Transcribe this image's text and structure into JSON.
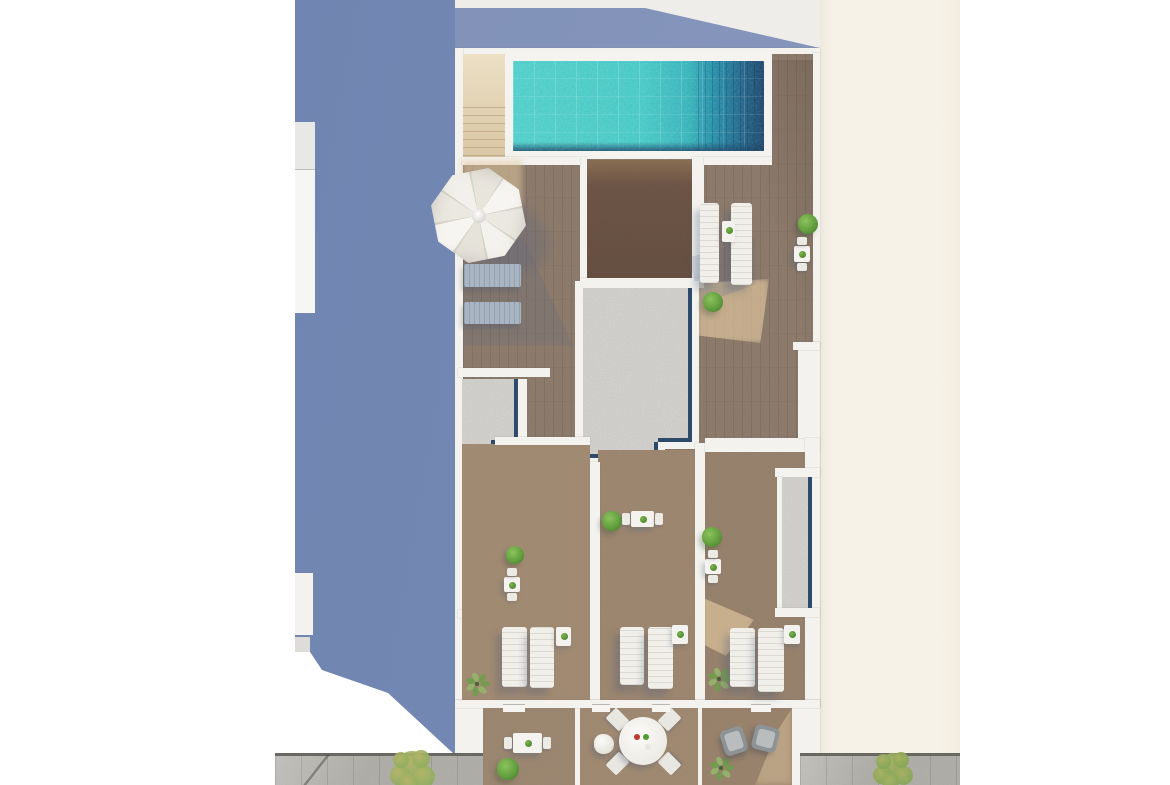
{
  "scene": {
    "type": "architectural-aerial-render",
    "description": "Top-down 3D architectural rendering of a narrow rooftop terrace: turquoise swimming pool with dark deep end at top, sand-colored stair block, white parasol, wooden deck, central gravel roof core, three private wood-floored patios with white sun loungers and small tables, three lower balconies with dining furniture, tall slate-blue side wall on the left and cream neighbouring wall on the right",
    "no_visible_text": true
  },
  "palette": {
    "wall_blue": "#7488b4",
    "awning_blue": "#8494ba",
    "cream_wall": "#f6f2e8",
    "white_wall": "#f3f2ee",
    "deck_wood": "#8d7b6c",
    "room_wood": "#a28b73",
    "dark_room_wood": "#6d5546",
    "terrace_wood": "#9c8771",
    "stairs_sand": "#e3d4b6",
    "sunlight_sand": "#e2c8a0",
    "pool_shallow": "#3fc6c3",
    "pool_deep": "#1b86a3",
    "pool_edge_navy": "#143f66",
    "gravel": "#c8c7c3",
    "planter_edge_navy": "#2e4a6b",
    "paving_gray": "#b2b0aa",
    "bush_green": "#639f3e",
    "plant_green": "#7ca85b",
    "tree_green": "#a3a95f",
    "lounger_white": "#f1efe9",
    "lounger_gray": "#aab5c3",
    "armchair_gray": "#8e9496",
    "umbrella_white": "#f0eee8",
    "accent_red": "#c0392b",
    "accent_green": "#4f9a33"
  },
  "objects": {
    "bushes": [
      {
        "x": 808,
        "y": 224,
        "r": 10
      },
      {
        "x": 713,
        "y": 302,
        "r": 10
      },
      {
        "x": 515,
        "y": 555,
        "r": 9
      },
      {
        "x": 612,
        "y": 521,
        "r": 10
      },
      {
        "x": 712,
        "y": 537,
        "r": 10
      },
      {
        "x": 508,
        "y": 769,
        "r": 11
      }
    ],
    "leafy_plants": [
      {
        "x": 477,
        "y": 684,
        "r": 14
      },
      {
        "x": 719,
        "y": 679,
        "r": 14
      },
      {
        "x": 721,
        "y": 768,
        "r": 14
      }
    ],
    "trees": [
      {
        "x": 412,
        "y": 770,
        "r": 27,
        "c1": "#b5b468",
        "c2": "#8fae5e"
      },
      {
        "x": 893,
        "y": 770,
        "r": 24,
        "c1": "#aab162",
        "c2": "#85a757"
      }
    ],
    "white_loungers": [
      {
        "x": 700,
        "y": 203,
        "w": 19,
        "h": 80
      },
      {
        "x": 731,
        "y": 203,
        "w": 21,
        "h": 82
      },
      {
        "x": 502,
        "y": 627,
        "w": 25,
        "h": 60
      },
      {
        "x": 530,
        "y": 627,
        "w": 24,
        "h": 61
      },
      {
        "x": 620,
        "y": 627,
        "w": 24,
        "h": 58
      },
      {
        "x": 648,
        "y": 627,
        "w": 25,
        "h": 62
      },
      {
        "x": 730,
        "y": 628,
        "w": 25,
        "h": 59
      },
      {
        "x": 758,
        "y": 628,
        "w": 26,
        "h": 64
      }
    ],
    "gray_loungers": [
      {
        "x": 464,
        "y": 264,
        "w": 57,
        "h": 23
      },
      {
        "x": 464,
        "y": 302,
        "w": 57,
        "h": 22
      }
    ],
    "side_tables": [
      {
        "x": 722,
        "y": 221,
        "w": 13,
        "h": 21
      },
      {
        "x": 556,
        "y": 627,
        "w": 15,
        "h": 19
      },
      {
        "x": 672,
        "y": 625,
        "w": 16,
        "h": 19
      },
      {
        "x": 784,
        "y": 625,
        "w": 16,
        "h": 19
      }
    ],
    "dining_sets": [
      {
        "x": 794,
        "y": 246,
        "w": 16,
        "h": 16,
        "o": "v"
      },
      {
        "x": 504,
        "y": 577,
        "w": 16,
        "h": 15,
        "o": "v"
      },
      {
        "x": 631,
        "y": 511,
        "w": 23,
        "h": 16,
        "o": "h"
      },
      {
        "x": 705,
        "y": 559,
        "w": 16,
        "h": 15,
        "o": "v"
      },
      {
        "x": 513,
        "y": 733,
        "w": 29,
        "h": 20,
        "o": "h"
      }
    ],
    "round_dining_set": {
      "x": 643,
      "y": 741,
      "r": 24,
      "items": [
        {
          "c": "#c0392b",
          "dx": -6,
          "dy": -4
        },
        {
          "c": "#4f9a33",
          "dx": 3,
          "dy": -4
        },
        {
          "c": "#e8e6e0",
          "dx": 5,
          "dy": 6
        }
      ]
    },
    "beanbag": {
      "x": 604,
      "y": 744,
      "r": 10
    },
    "armchairs": [
      {
        "x": 722,
        "y": 728,
        "w": 24,
        "h": 26,
        "rot": -18
      },
      {
        "x": 753,
        "y": 726,
        "w": 25,
        "h": 25,
        "rot": 14
      }
    ],
    "thresholds": [
      {
        "x": 503,
        "y": 704,
        "w": 22,
        "h": 7
      },
      {
        "x": 592,
        "y": 704,
        "w": 18,
        "h": 7
      },
      {
        "x": 652,
        "y": 704,
        "w": 18,
        "h": 7
      },
      {
        "x": 751,
        "y": 704,
        "w": 20,
        "h": 7
      }
    ]
  }
}
